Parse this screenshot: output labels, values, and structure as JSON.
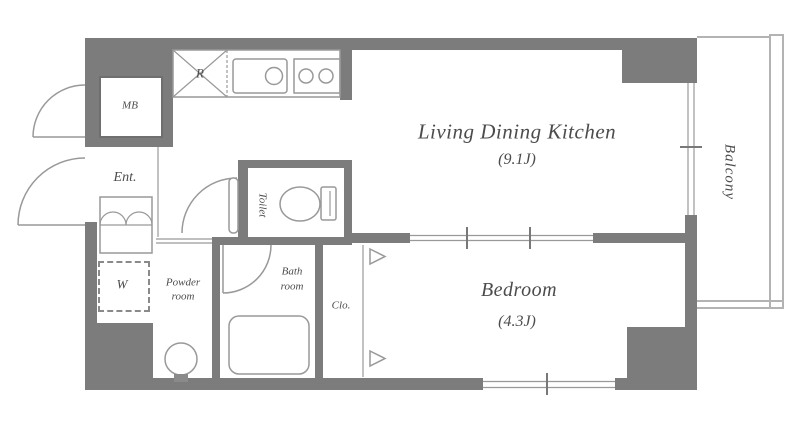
{
  "title": "Apartment floor plan",
  "colors": {
    "wall": "#7c7c7c",
    "line": "#999999",
    "fixture": "#9a9a9a",
    "balcony_line": "#b3b3b3",
    "text": "#4c4c4c"
  },
  "rooms": {
    "ldk": {
      "name": "Living Dining Kitchen",
      "size": "(9.1J)"
    },
    "bedroom": {
      "name": "Bedroom",
      "size": "(4.3J)"
    },
    "balcony": {
      "name": "Balcony"
    },
    "entrance": {
      "name": "Ent."
    },
    "toilet": {
      "name": "Toilet"
    },
    "bath_room": {
      "line1": "Bath",
      "line2": "room"
    },
    "powder_room": {
      "line1": "Powder",
      "line2": "room"
    },
    "closet": {
      "name": "Clo."
    },
    "meter_box": {
      "name": "MB"
    },
    "washing_machine": {
      "name": "W"
    },
    "refrigerator": {
      "name": "R"
    }
  }
}
